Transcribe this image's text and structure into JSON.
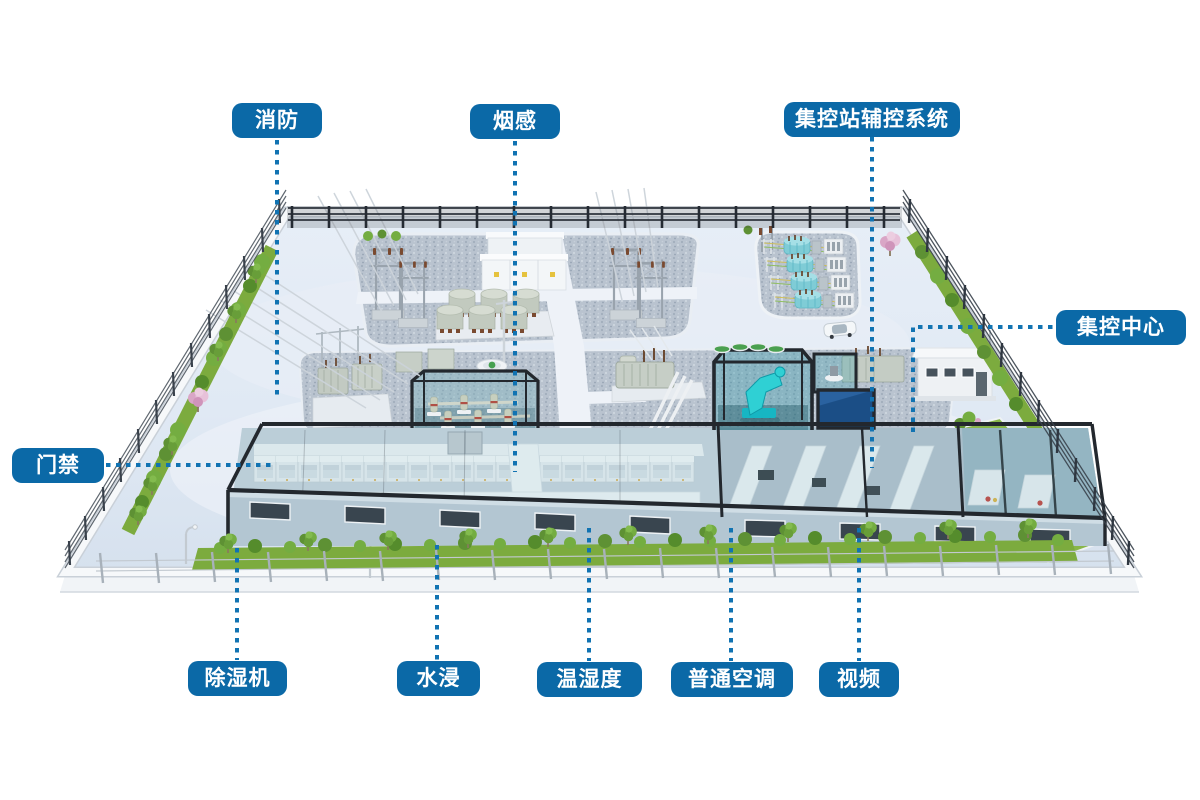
{
  "diagram_title": "substation-auxiliary-monitoring-overview",
  "labels": [
    {
      "id": "fire",
      "text": "消防"
    },
    {
      "id": "smoke",
      "text": "烟感"
    },
    {
      "id": "aux_control",
      "text": "集控站辅控系统"
    },
    {
      "id": "control_center",
      "text": "集控中心"
    },
    {
      "id": "access_control",
      "text": "门禁"
    },
    {
      "id": "dehumidifier",
      "text": "除湿机"
    },
    {
      "id": "water_leak",
      "text": "水浸"
    },
    {
      "id": "temp_humidity",
      "text": "温湿度"
    },
    {
      "id": "normal_ac",
      "text": "普通空调"
    },
    {
      "id": "video",
      "text": "视频"
    }
  ],
  "colors": {
    "label_bg": "#0b69a7",
    "label_text": "#ffffff",
    "connector": "#1173b2",
    "ground": "#dde7f2",
    "gravel": "#b9c3cf",
    "grass": "#7cab3e",
    "teal_equipment": "#2fd0d4",
    "teal_transformer": "#7fccd6",
    "pool_water": "#1b4e86",
    "building_frame": "#23282e",
    "sakura": "#d9a6c6",
    "background": "#ffffff"
  }
}
